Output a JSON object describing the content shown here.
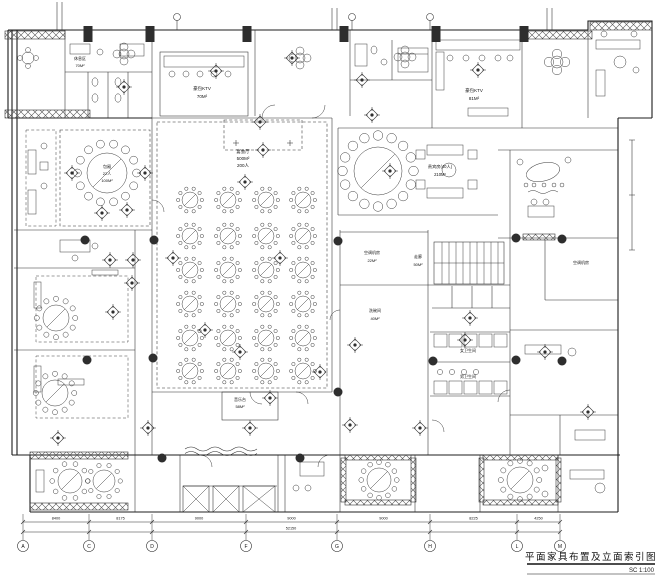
{
  "drawing": {
    "title": "平面家具布置及立面索引图",
    "scale": "SC 1:100"
  },
  "rooms": {
    "banquet": {
      "name": "宴会厅",
      "area": "500M²",
      "capacity": "200人"
    },
    "stage": {
      "name": "音乐台",
      "area": "58M²"
    },
    "ktv_left": {
      "name": "豪包KTV",
      "area": "70M²"
    },
    "ktv_right": {
      "name": "豪包KTV",
      "area": "81M²"
    },
    "lounge": {
      "name": "休息区",
      "area": "70M²"
    },
    "vip_left": {
      "name": "包厢",
      "capacity": "22人",
      "area": "100M²"
    },
    "vip_right": {
      "name": "贵宾房(40人)",
      "area": "210M²"
    },
    "ac_room_mid": {
      "name": "空调机房",
      "area": "22M²"
    },
    "ac_room_right": {
      "name": "空调机房"
    },
    "corridor": {
      "name": "走廊",
      "area": "50M²"
    },
    "dishwash": {
      "name": "洗碗间",
      "area": "40M²"
    },
    "wc_women": {
      "name": "女卫生间"
    },
    "wc_men": {
      "name": "男卫生间"
    }
  },
  "grid": {
    "axis_labels": [
      "A",
      "C",
      "D",
      "F",
      "G",
      "H",
      "L",
      "M"
    ],
    "dimensions": [
      "8400",
      "8175",
      "9000",
      "9000",
      "9000",
      "8225",
      "4250"
    ],
    "total_dimension": "52150"
  },
  "colors": {
    "ink": "#1c1c1c",
    "paper": "#ffffff",
    "column": "#2e2e2e"
  }
}
